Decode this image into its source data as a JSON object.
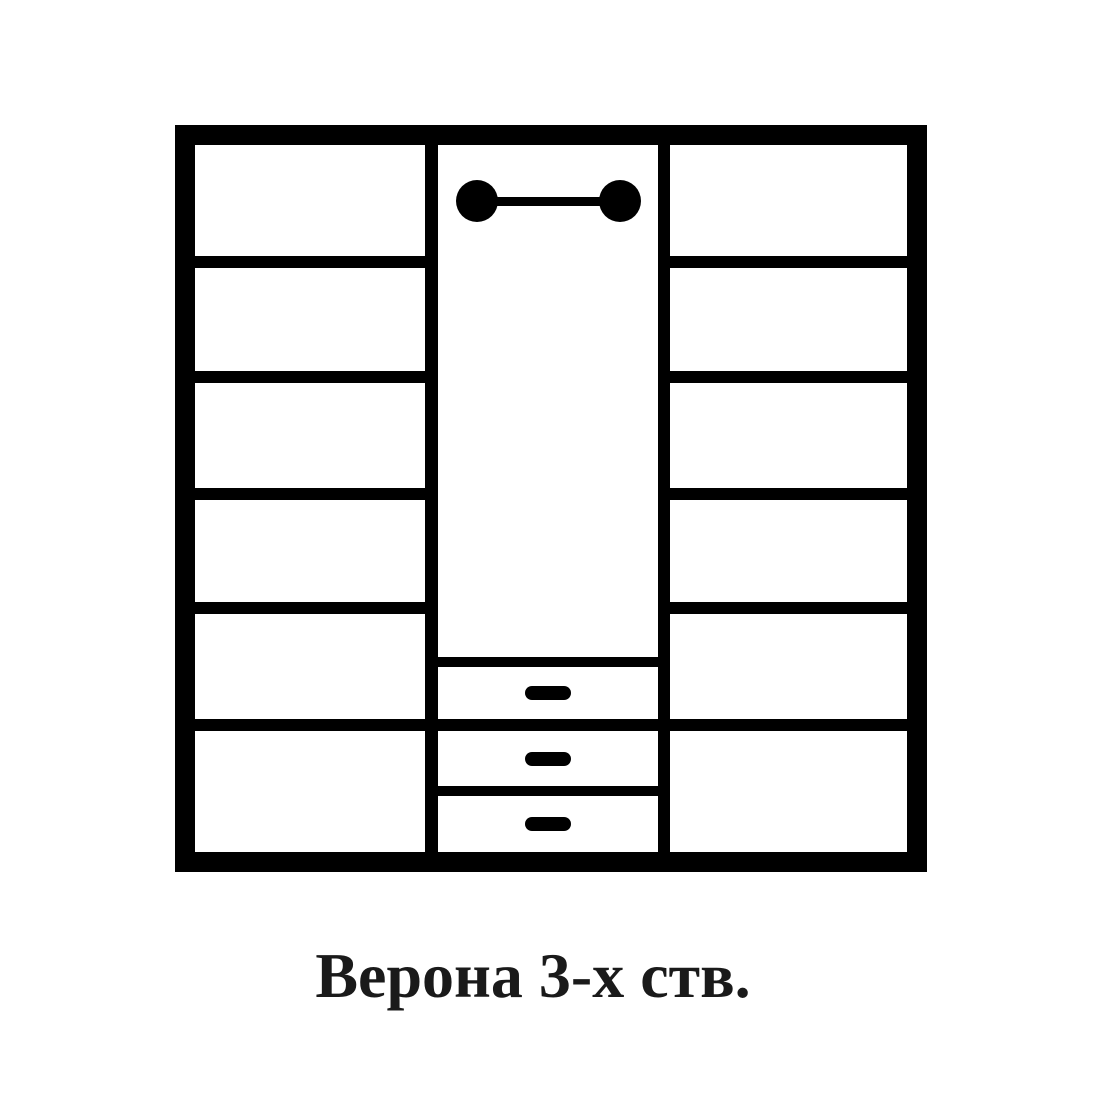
{
  "page": {
    "background_color": "#ffffff"
  },
  "caption": {
    "text": "Верона 3-х ств.",
    "color": "#1a1a1a"
  },
  "diagram": {
    "kind": "wardrobe-front-schematic",
    "line_color": "#000000",
    "fill_color": "#ffffff",
    "left_column": {
      "shelf_count": 6
    },
    "right_column": {
      "shelf_count": 6
    },
    "middle_column": {
      "hanger_rod": "rod-with-round-ends",
      "drawer_count": 3,
      "drawer_handle": "black-pill"
    }
  }
}
